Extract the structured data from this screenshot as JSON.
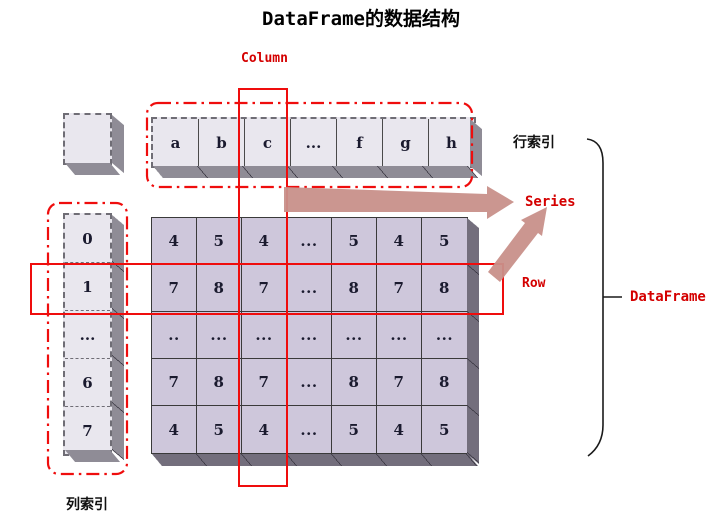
{
  "title": "DataFrame的数据结构",
  "labels": {
    "column": "Column",
    "row_index": "行索引",
    "series": "Series",
    "row": "Row",
    "dataframe": "DataFrame",
    "col_index": "列索引"
  },
  "header_cells": [
    "a",
    "b",
    "c",
    "...",
    "f",
    "g",
    "h"
  ],
  "index_cells": [
    "0",
    "1",
    "...",
    "6",
    "7"
  ],
  "grid_rows": [
    [
      "4",
      "5",
      "4",
      "...",
      "5",
      "4",
      "5"
    ],
    [
      "7",
      "8",
      "7",
      "...",
      "8",
      "7",
      "8"
    ],
    [
      "..",
      "...",
      "...",
      "...",
      "...",
      "...",
      "..."
    ],
    [
      "7",
      "8",
      "7",
      "...",
      "8",
      "7",
      "8"
    ],
    [
      "4",
      "5",
      "4",
      "...",
      "5",
      "4",
      "5"
    ]
  ],
  "colors": {
    "highlight_red": "#ef0d0d",
    "label_red": "#d40000",
    "arrow_pink": "#c8908a",
    "data_cell": "#cec7db",
    "index_cell": "#e9e7ee",
    "side_face_dark": "#736e7c",
    "side_face_gray": "#8f8c96",
    "brace": "#1a1a1a"
  }
}
